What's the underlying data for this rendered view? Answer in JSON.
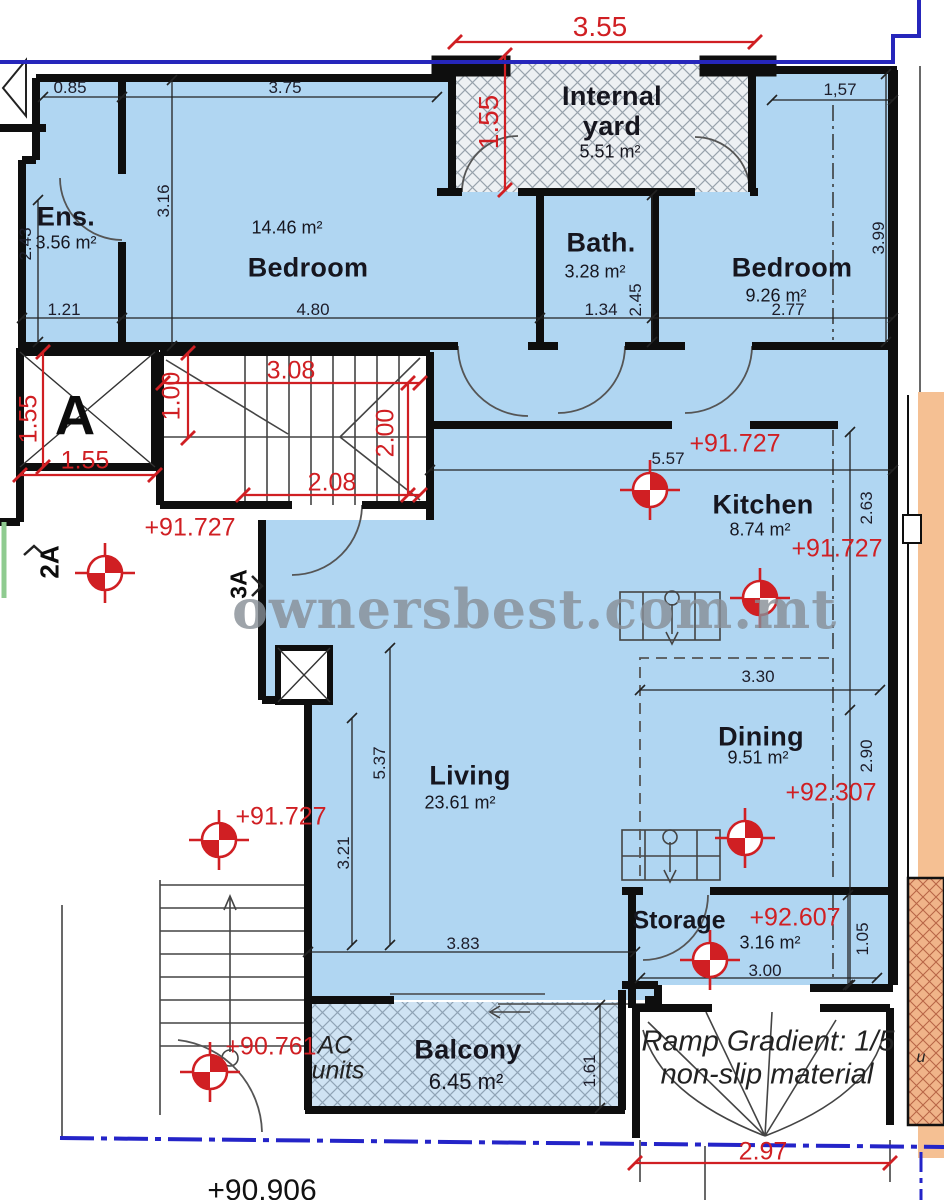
{
  "watermark": "ownersbest.com.mt",
  "plan": {
    "rooms": {
      "yard": {
        "name": "Internal yard",
        "area": "5.51 m²"
      },
      "ens": {
        "name": "Ens.",
        "area": "3.56 m²"
      },
      "bedroom_left": {
        "name": "Bedroom",
        "area": "14.46 m²"
      },
      "bath": {
        "name": "Bath.",
        "area": "3.28 m²"
      },
      "bedroom_right": {
        "name": "Bedroom",
        "area": "9.26 m²"
      },
      "kitchen": {
        "name": "Kitchen",
        "area": "8.74 m²"
      },
      "living": {
        "name": "Living",
        "area": "23.61 m²"
      },
      "dining": {
        "name": "Dining",
        "area": "9.51 m²"
      },
      "storage": {
        "name": "Storage",
        "area": "3.16 m²"
      },
      "balcony": {
        "name": "Balcony",
        "area": "6.45 m²"
      }
    },
    "levels": {
      "hall": "+91.727",
      "kitchen_a": "+91.727",
      "kitchen_b": "+91.727",
      "living": "+91.727",
      "dining": "+92.307",
      "storage": "+92.607",
      "stairs": "+90.761",
      "street": "+90.906"
    },
    "dims_black": {
      "d085": "0.85",
      "d375": "3.75",
      "d157": "1,57",
      "d243": "2.43",
      "d316": "3.16",
      "d399": "3.99",
      "d121": "1.21",
      "d480": "4.80",
      "d134": "1.34",
      "d245": "2.45",
      "d277": "2.77",
      "d557": "5.57",
      "d263": "2.63",
      "d330": "3.30",
      "d290": "2.90",
      "d537": "5.37",
      "d321": "3.21",
      "d383": "3.83",
      "d105": "1.05",
      "d300": "3.00",
      "d161": "1.61"
    },
    "dims_red": {
      "d355": "3.55",
      "d155_yard": "1.55",
      "d155_lift_v": "1.55",
      "d155_lift_h": "1.55",
      "d100": "1.00",
      "d308": "3.08",
      "d200": "2.00",
      "d208": "2.08",
      "d297": "2.97"
    },
    "markers": {
      "section_a": "A",
      "section_2a": "2A",
      "section_3a": "3A"
    },
    "notes": {
      "ramp_line1": "Ramp Gradient: 1/5",
      "ramp_line2": "non-slip material",
      "ac_line1": "AC",
      "ac_line2": "units",
      "partial_u": "u"
    }
  }
}
